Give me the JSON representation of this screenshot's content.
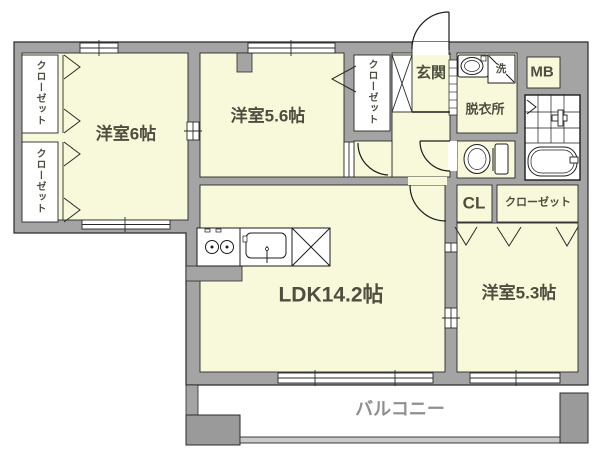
{
  "floor_plan": {
    "title": "apartment-floor-plan",
    "rooms": {
      "bedroom6": {
        "label": "洋室6帖"
      },
      "bedroom56": {
        "label": "洋室5.6帖"
      },
      "ldk": {
        "label": "LDK14.2帖"
      },
      "bedroom53": {
        "label": "洋室5.3帖"
      },
      "balcony": {
        "label": "バルコニー"
      },
      "entrance": {
        "label": "玄関"
      },
      "dressing_room": {
        "label": "脱衣所"
      }
    },
    "storage": {
      "closet_left_top": {
        "label": "クローゼット"
      },
      "closet_left_bottom": {
        "label": "クローゼット"
      },
      "closet_mid": {
        "label": "クローゼット"
      },
      "closet_right": {
        "label": "クローゼット"
      },
      "cl": {
        "label": "CL"
      },
      "mb": {
        "label": "MB"
      }
    },
    "fixtures": {
      "washer": {
        "label": "洗"
      }
    },
    "colors": {
      "wall": "#a4a4a4",
      "floor": "#f8f8da",
      "outline": "#2a2a2a",
      "label": "#4e4e40",
      "balcony_label": "#8f8f8f",
      "white": "#ffffff"
    }
  }
}
